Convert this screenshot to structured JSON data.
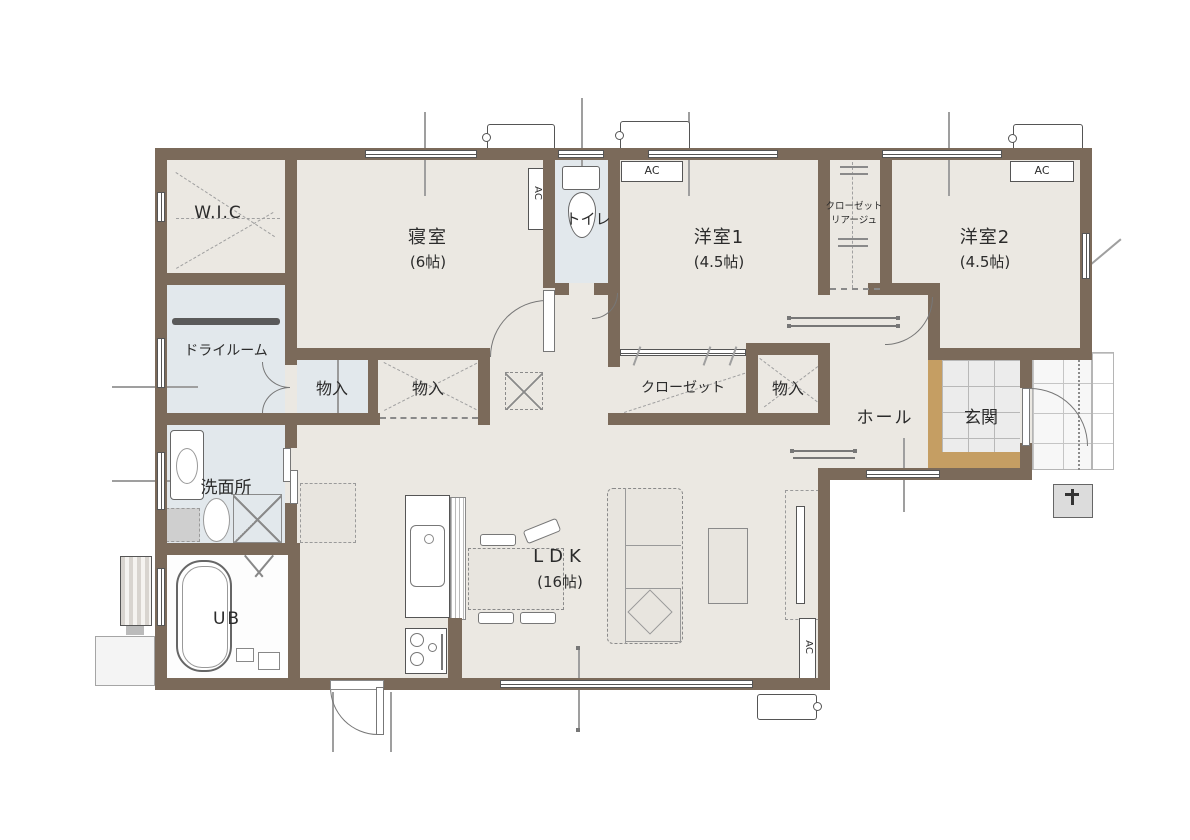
{
  "palette": {
    "wall": "#7b6a5a",
    "floor": "#ebe8e2",
    "floor_wet": "#e2e8ec",
    "floor_bath": "#fdfdfd",
    "tile": "#ececec",
    "tile_outdoor": "#f7f7f7",
    "step": "#c59e63",
    "furniture": "#e8e5df",
    "line": "#777777",
    "text": "#2b2b2b"
  },
  "labels": {
    "wic": "W.I.C",
    "bedroom": "寝室",
    "bedroom_size": "(6帖)",
    "toilet": "トイレ",
    "western1": "洋室1",
    "western1_size": "(4.5帖)",
    "western2": "洋室2",
    "western2_size": "(4.5帖)",
    "closet_liage_1": "クローゼット",
    "closet_liage_2": "リアージュ",
    "dry_room": "ドライルーム",
    "storage": "物入",
    "closet": "クローゼット",
    "hall": "ホール",
    "entrance": "玄関",
    "washroom": "洗面所",
    "unit_bath": "UB",
    "ldk": "LDK",
    "ldk_size": "(16帖)",
    "ac": "AC"
  }
}
